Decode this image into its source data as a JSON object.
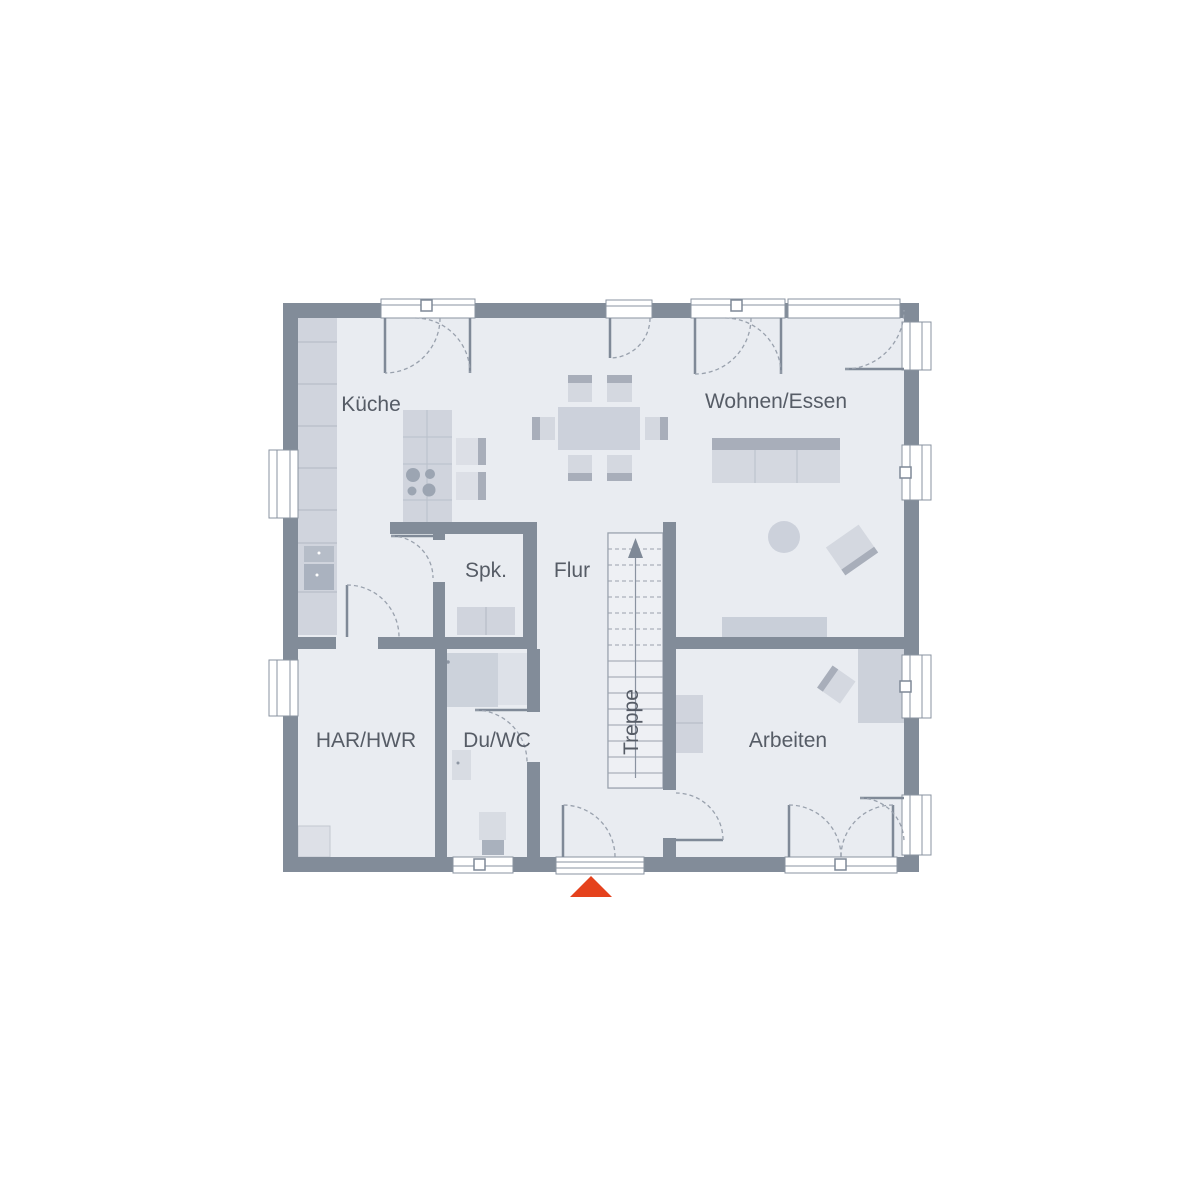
{
  "plan": {
    "type": "floor-plan",
    "rooms": [
      {
        "id": "kueche",
        "label": "Küche"
      },
      {
        "id": "wohnen-essen",
        "label": "Wohnen/Essen"
      },
      {
        "id": "spk",
        "label": "Spk."
      },
      {
        "id": "flur",
        "label": "Flur"
      },
      {
        "id": "treppe",
        "label": "Treppe"
      },
      {
        "id": "har-hwr",
        "label": "HAR/HWR"
      },
      {
        "id": "du-wc",
        "label": "Du/WC"
      },
      {
        "id": "arbeiten",
        "label": "Arbeiten"
      }
    ],
    "stairs": {
      "direction": "up",
      "treads_dashed": 7,
      "treads_solid": 8
    },
    "entrance_marker": {
      "shape": "triangle-up",
      "position": "bottom-center"
    }
  },
  "colors": {
    "wall": "#828c99",
    "floor": "#e9ecf1",
    "stairfloor": "#eef0f4",
    "furn-light": "#dcdfe6",
    "furn-mid": "#d0d4dd",
    "furn-seat": "#d4d8e0",
    "furn-dark": "#a8aeba",
    "line": "#99a1ad",
    "frame": "#8a93a0",
    "label": "#565c66",
    "accent": "#e5421d"
  }
}
